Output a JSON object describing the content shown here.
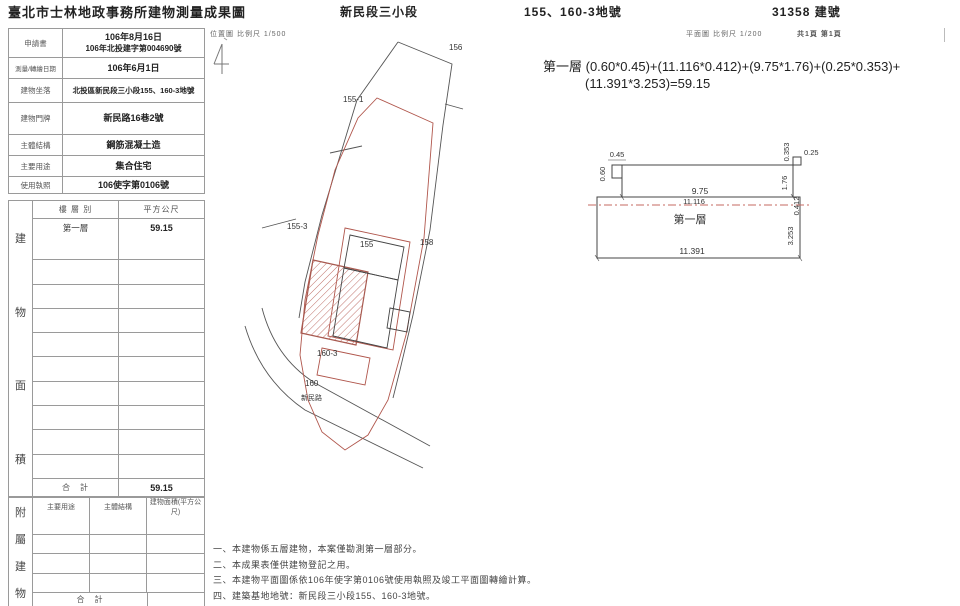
{
  "header": {
    "title": "臺北市士林地政事務所建物測量成果圖",
    "section": "新民段三小段",
    "parcels": "155、160-3地號",
    "building_no": "31358 建號"
  },
  "info": {
    "rows": [
      {
        "label": "申請書",
        "line1": "106年8月16日",
        "line2": "106年北投建字第004690號"
      },
      {
        "label": "測量/轉繪日期",
        "line1": "106年6月1日"
      },
      {
        "label": "建物坐落",
        "line1": "北投區新民段三小段155、160-3地號"
      },
      {
        "label": "建物門牌",
        "line1": "新民路16巷2號"
      },
      {
        "label": "主體結構",
        "line1": "鋼筋混凝土造"
      },
      {
        "label": "主要用途",
        "line1": "集合住宅"
      },
      {
        "label": "使用執照",
        "line1": "106使字第0106號"
      }
    ]
  },
  "area": {
    "side": [
      "建",
      "物",
      "面",
      "積"
    ],
    "col_floor": "樓 層 別",
    "col_sqm": "平方公尺",
    "floor1": "第一層",
    "floor1_area": "59.15",
    "total_label": "合　計",
    "total_value": "59.15"
  },
  "annex": {
    "side": [
      "附",
      "屬",
      "建",
      "物"
    ],
    "col_use": "主要用途",
    "col_structure": "主體結構",
    "col_area": "建物面積(平方公尺)",
    "total_label": "合　計"
  },
  "site": {
    "scale": "位置圖 比例尺 1/500",
    "labels": {
      "p156": "156",
      "p155_1": "155-1",
      "p155_3": "155-3",
      "p155": "155",
      "p158": "158",
      "p160_3": "160-3",
      "p160": "160",
      "road": "新民路"
    }
  },
  "plan": {
    "scale": "平面圖 比例尺 1/200",
    "pages": "共1頁 第1頁",
    "formula1": "第一層 (0.60*0.45)+(11.116*0.412)+(9.75*1.76)+(0.25*0.353)+",
    "formula2": "(11.391*3.253)=59.15",
    "room": "第一層",
    "dims": {
      "a": "0.45",
      "b": "0.60",
      "c": "0.353",
      "d": "0.25",
      "e": "9.75",
      "f": "11.116",
      "g": "1.76",
      "h": "0.412",
      "i": "3.253",
      "j": "11.391"
    }
  },
  "notes": [
    "一、本建物係五層建物，本案僅勘測第一層部分。",
    "二、本成果表僅供建物登記之用。",
    "三、本建物平面圖係依106年使字第0106號使用執照及竣工平面圖轉繪計算。",
    "四、建築基地地號：新民段三小段155、160-3地號。"
  ],
  "colors": {
    "red": "#b0564c",
    "ink": "#333333",
    "grid": "#9a9a9a"
  }
}
